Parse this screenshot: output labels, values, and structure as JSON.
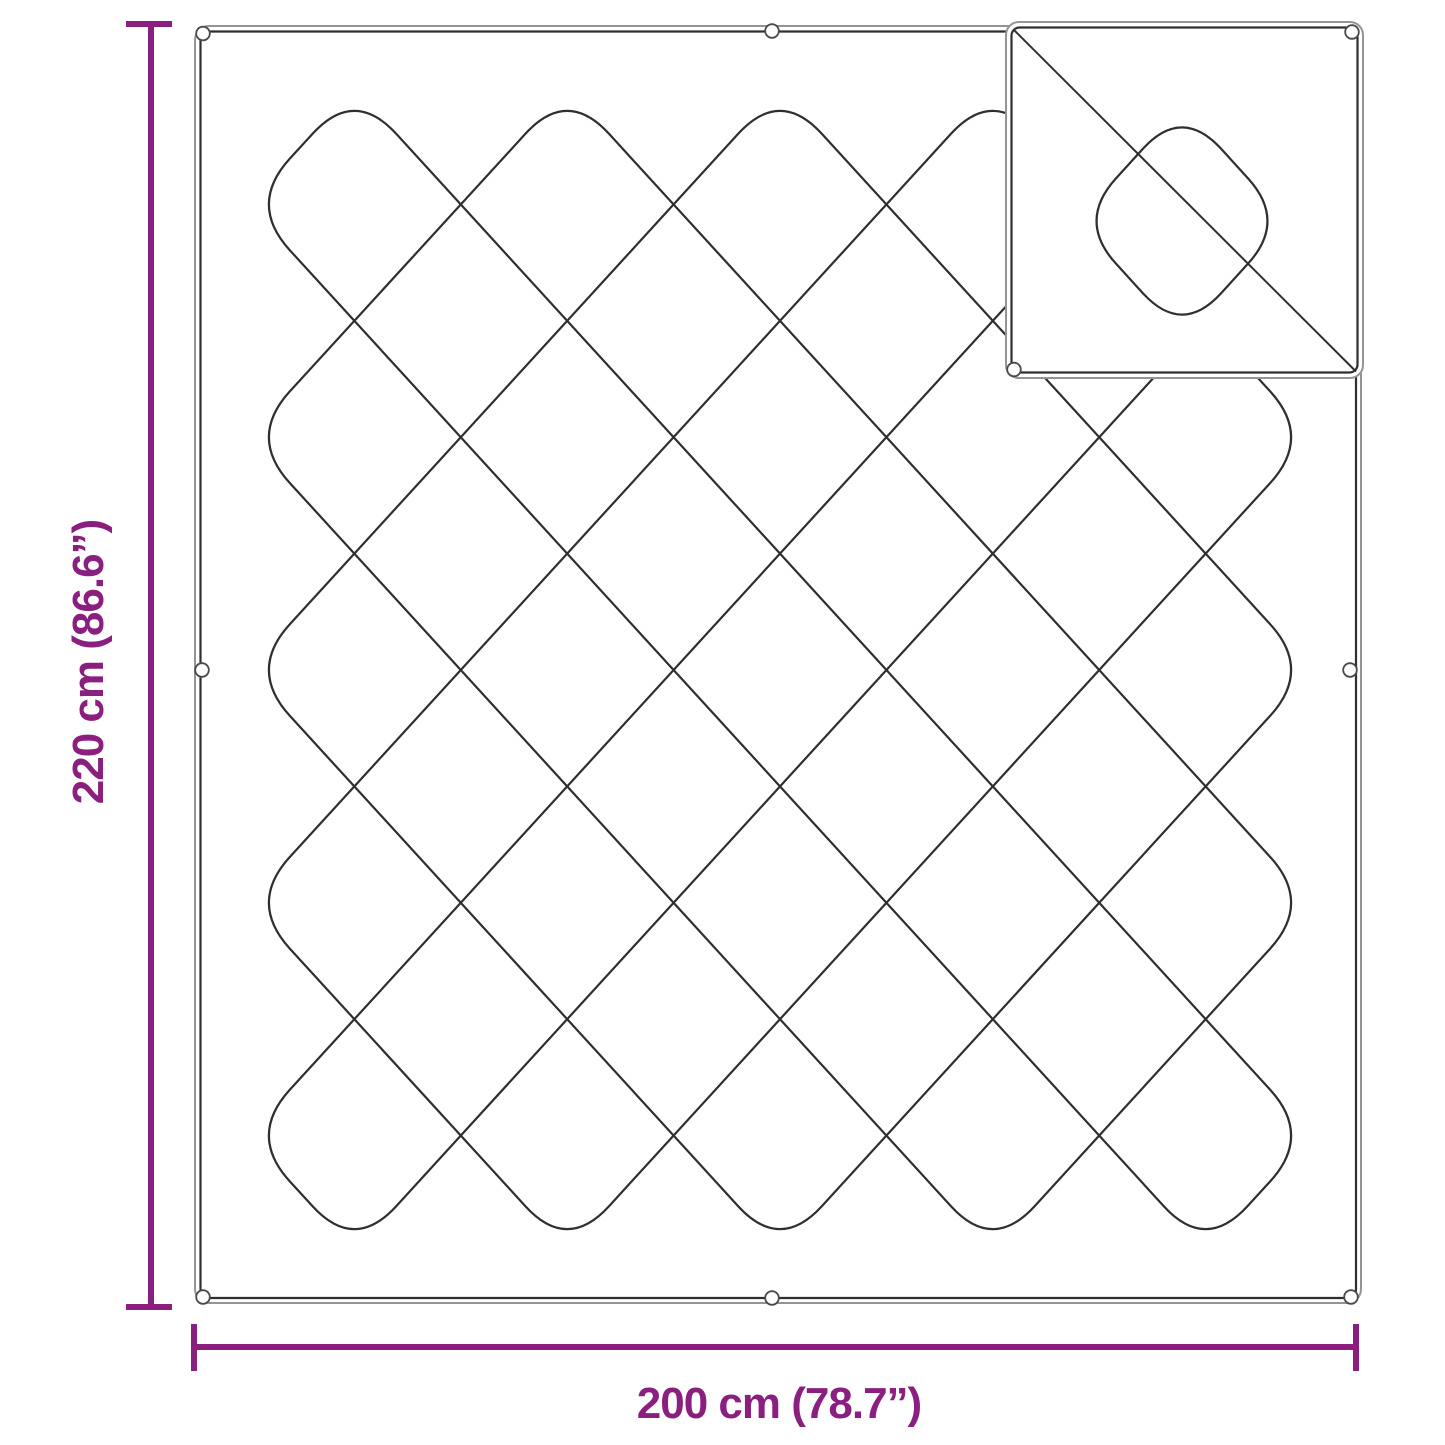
{
  "diagram": {
    "height_label": "220 cm (86.6”)",
    "width_label": "200 cm (78.7”)",
    "accent_color": "#8a1f7f",
    "outline_color": "#2f2f2f",
    "outline_shadow_color": "#949494"
  }
}
